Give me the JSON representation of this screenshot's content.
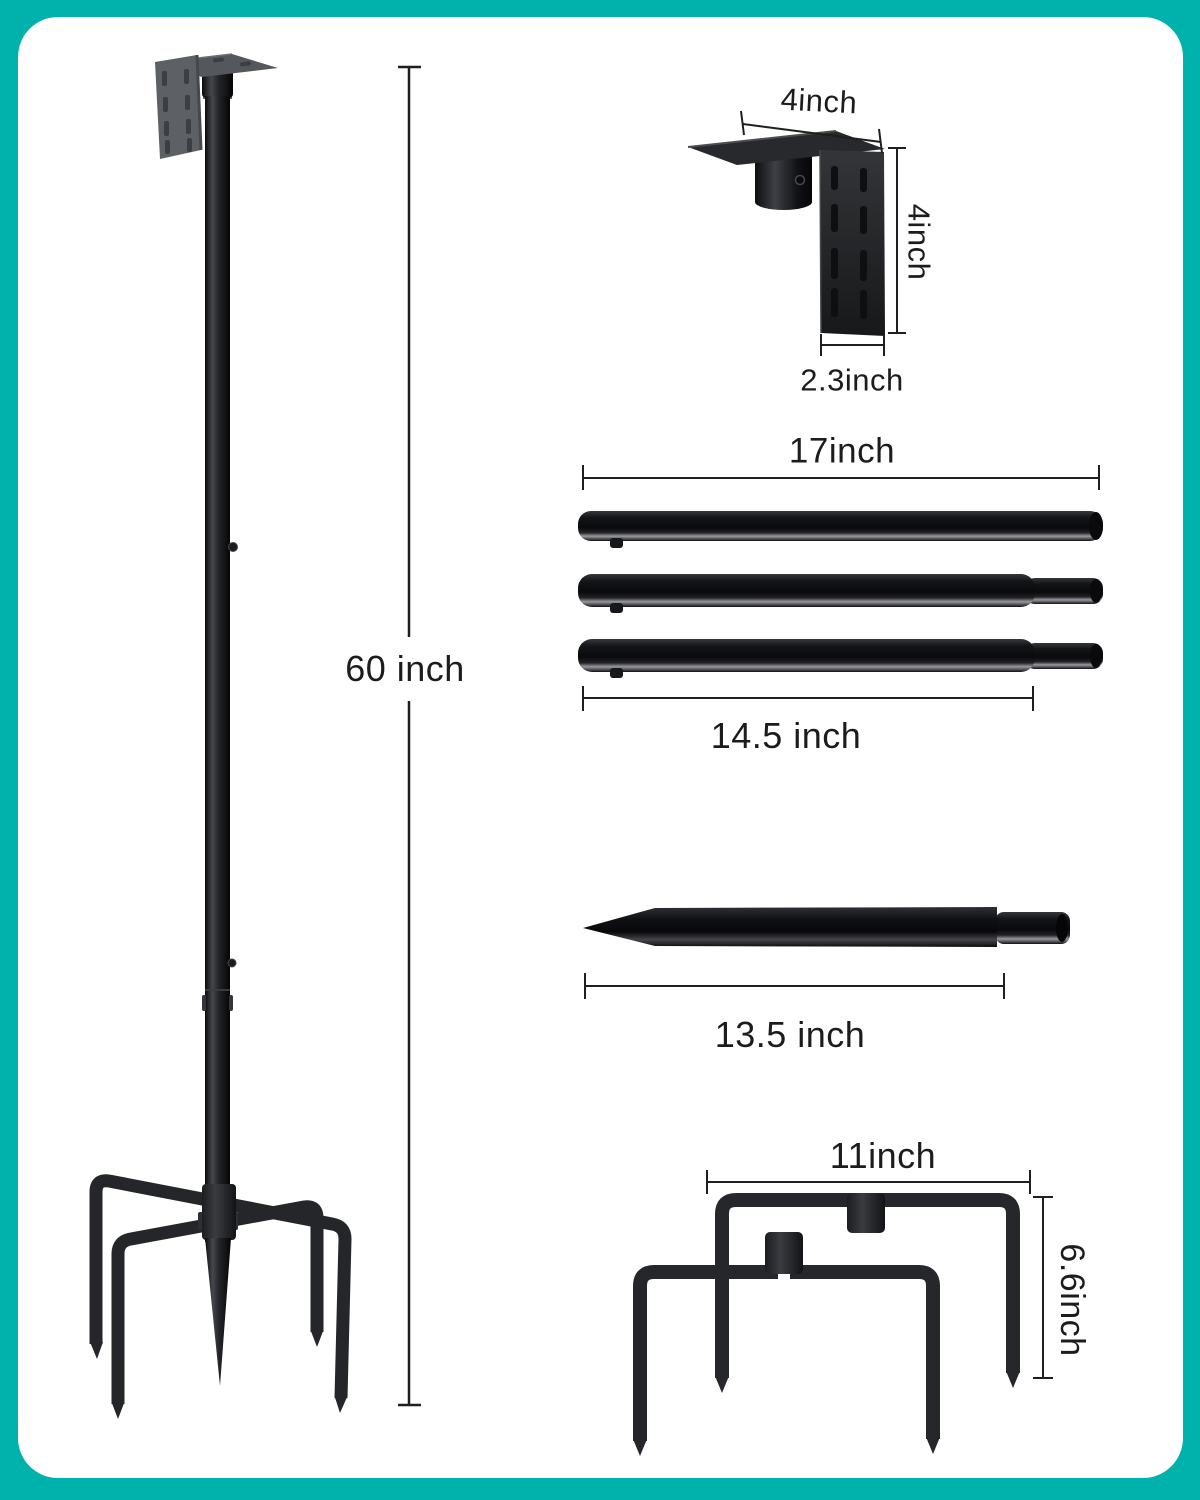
{
  "colors": {
    "bg": "#00b2ab",
    "panel": "#ffffff",
    "ink": "#1c1c1c",
    "metal_dark": "#131417",
    "metal_gray": "#5d6165"
  },
  "figure": {
    "assembled_pole": {
      "height_label": "60 inch"
    },
    "mounting_bracket": {
      "width_label": "4inch",
      "height_label": "4inch",
      "depth_label": "2.3inch"
    },
    "pole_tubes": {
      "full_length_label": "17inch",
      "body_length_label": "14.5 inch"
    },
    "ground_spike": {
      "length_label": "13.5 inch"
    },
    "prong_base": {
      "width_label": "11inch",
      "height_label": "6.6inch"
    }
  }
}
